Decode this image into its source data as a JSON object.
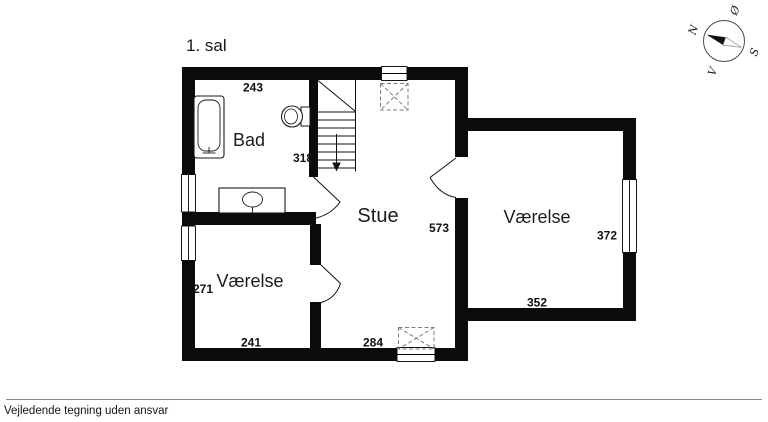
{
  "page": {
    "title": "1. sal",
    "disclaimer": "Vejledende tegning uden ansvar"
  },
  "compass": {
    "north": "N",
    "east": "Ø",
    "south": "S",
    "west": "V"
  },
  "rooms": [
    {
      "id": "bad",
      "label": "Bad"
    },
    {
      "id": "stue",
      "label": "Stue"
    },
    {
      "id": "vaerelse-left",
      "label": "Værelse"
    },
    {
      "id": "vaerelse-right",
      "label": "Værelse"
    }
  ],
  "measurements": [
    {
      "value": "243",
      "location": "bad-top-width"
    },
    {
      "value": "318",
      "location": "bad-stairwell-depth"
    },
    {
      "value": "573",
      "location": "stue-depth"
    },
    {
      "value": "284",
      "location": "stue-bottom-width"
    },
    {
      "value": "241",
      "location": "vaerelse-left-bottom-width"
    },
    {
      "value": "271",
      "location": "vaerelse-left-depth"
    },
    {
      "value": "372",
      "location": "vaerelse-right-depth"
    },
    {
      "value": "352",
      "location": "vaerelse-right-bottom-width"
    }
  ],
  "colors": {
    "wall": "#0b0b0b",
    "dashed": "#7d7d7d",
    "footer_rule": "#8a8a8a"
  }
}
